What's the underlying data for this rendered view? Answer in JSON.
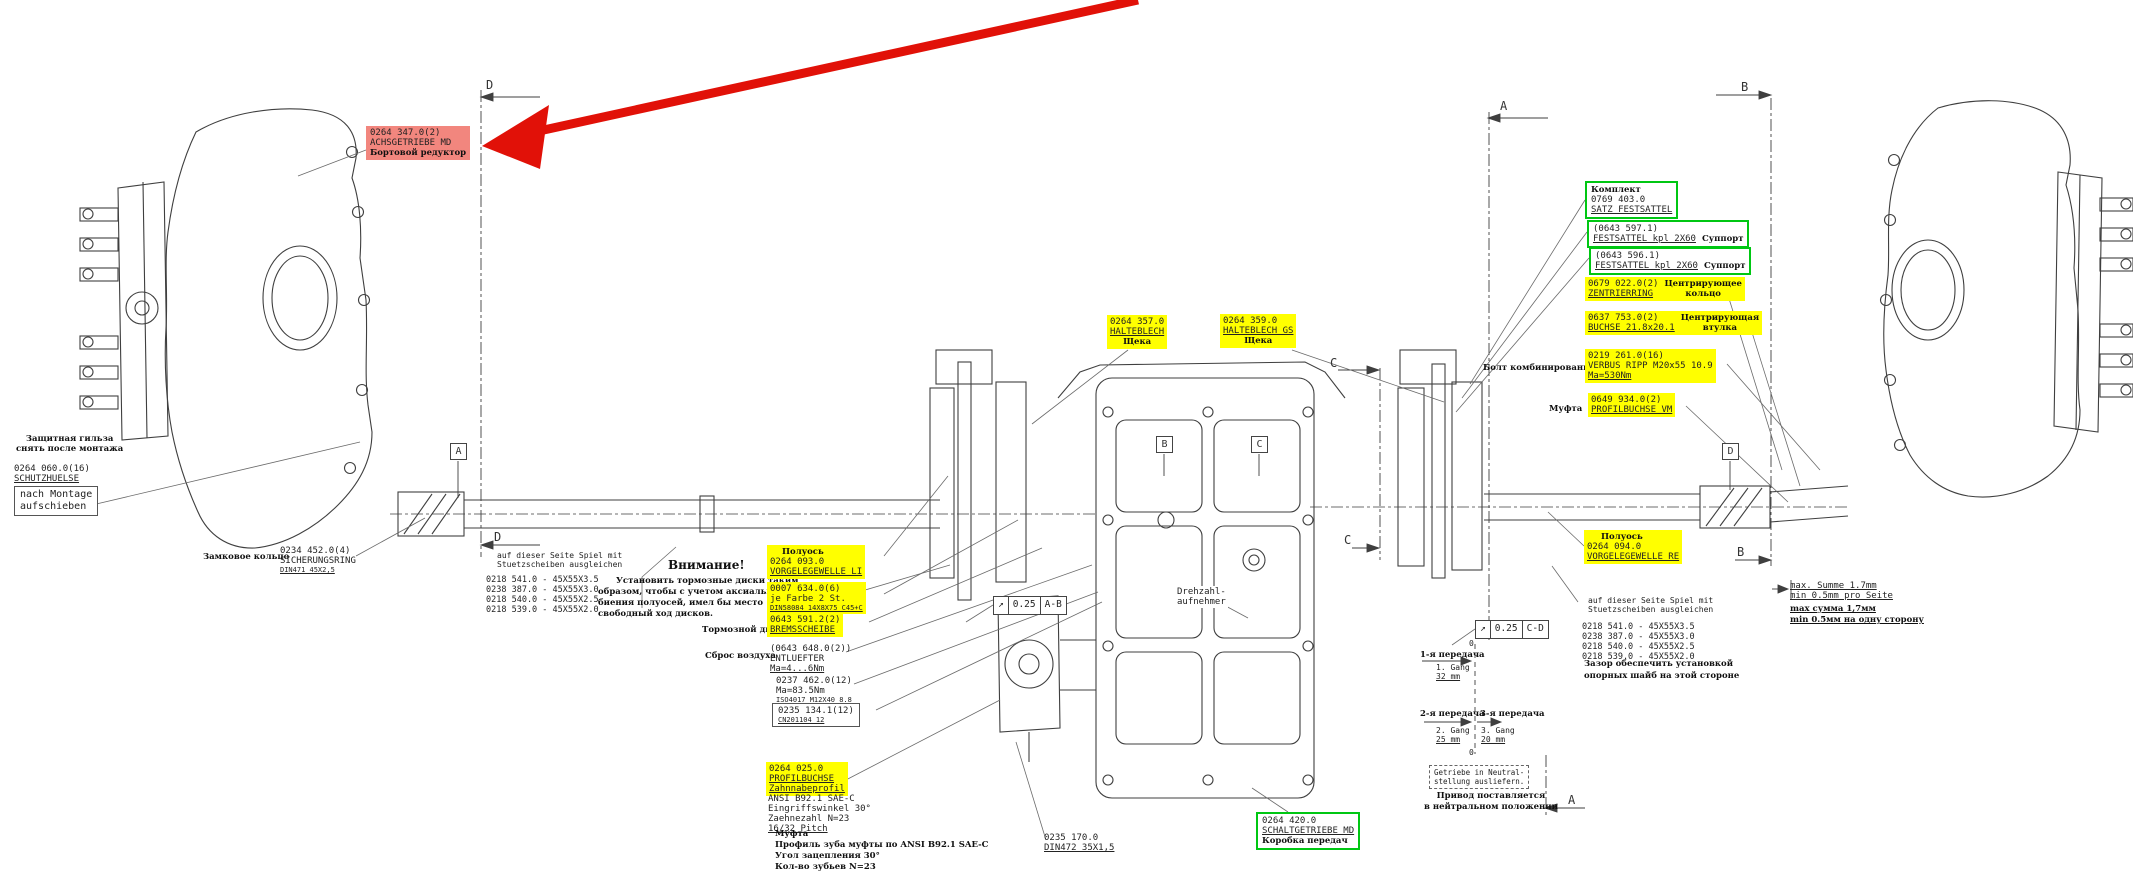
{
  "colors": {
    "highlight": "#ffff00",
    "green": "#00c713",
    "red_bg": "#f2867e",
    "arrow_red": "#e11108",
    "line": "#3f3f3f"
  },
  "red_callout": {
    "part": "0264 347.0(2)",
    "name": "ACHSGETRIEBE MD",
    "ru": "Бортовой редуктор"
  },
  "sleeve": {
    "ru1": "Защитная гильза",
    "ru2": "снять после монтажа",
    "part": "0264 060.0(16)",
    "name": "SCHUTZHUELSE",
    "note1": "nach Montage",
    "note2": "aufschieben"
  },
  "ring": {
    "ru": "Замковое кольцо",
    "part": "0234 452.0(4)",
    "name": "SICHERUNGSRING",
    "std": "DIN471 45X2,5"
  },
  "shims": {
    "note1": "auf dieser Seite Spiel mit",
    "note2": "Stuetzscheiben ausgleichen",
    "rows": [
      "0218 541.0 - 45X55X3.5",
      "0238 387.0 - 45X55X3.0",
      "0218 540.0 - 45X55X2.5",
      "0218 539.0 - 45X55X2.0"
    ],
    "ru1": "Зазор обеспечить установкой",
    "ru2": "опорных шайб на этой стороне"
  },
  "attention": {
    "title": "Внимание!",
    "l1": "Установить тормозные диски таким",
    "l2": "образом, чтобы с учетом аксиального",
    "l3": "биения полуосей, имел бы место",
    "l4": "свободный ход дисков."
  },
  "axle_left": {
    "ru": "Полуось",
    "part": "0264 093.0",
    "name": "VORGELEGEWELLE LI"
  },
  "axle_right": {
    "ru": "Полуось",
    "part": "0264 094.0",
    "name": "VORGELEGEWELLE RE"
  },
  "farbe": {
    "part": "0007 634.0(6)",
    "l2": "je Farbe 2 St.",
    "std": "DIN58084 14X8X75 C45+C"
  },
  "brake": {
    "ru": "Тормозной диск",
    "part": "0643 591.2(2)",
    "name": "BREMSSCHEIBE"
  },
  "vent": {
    "ru": "Сброс воздуха",
    "part": "(0643 648.0(2))",
    "name": "ENTLUEFTER",
    "torque": "Ma=4...6Nm"
  },
  "bolt12": {
    "part": "0237 462.0(12)",
    "torque": "Ma=83.5Nm",
    "std": "ISO4017 M12X40 8.8"
  },
  "washer12": {
    "part": "0235 134.1(12)",
    "std": "CN201104 12"
  },
  "profil": {
    "part": "0264 025.0",
    "name": "PROFILBUCHSE",
    "l3": "Zahnnabeprofil",
    "l4": "ANSI B92.1 SAE-C",
    "l5": "Eingriffswinkel 30°",
    "l6": "Zaehnezahl N=23",
    "l7": "16/32 Pitch",
    "ru1": "Муфта",
    "ru2": "Профиль зуба муфты по ANSI B92.1 SAE-C",
    "ru3": "Угол зацепления 30°",
    "ru4": "Кол-во зубьев N=23"
  },
  "circlip": {
    "part": "0235 170.0",
    "std": "DIN472 35X1,5"
  },
  "gearbox": {
    "part": "0264 420.0",
    "name": "SCHALTGETRIEBE MD",
    "ru": "Коробка передач"
  },
  "halteblech1": {
    "part": "0264 357.0",
    "name": "HALTEBLECH",
    "ru": "Щека"
  },
  "halteblech2": {
    "part": "0264 359.0",
    "name": "HALTEBLECH GS",
    "ru": "Щека"
  },
  "caliper_set": {
    "ru": "Комплект",
    "part": "0769 403.0",
    "name": "SATZ FESTSATTEL"
  },
  "caliper1": {
    "part": "(0643 597.1)",
    "name": "FESTSATTEL kpl 2X60",
    "ru": "Суппорт"
  },
  "caliper2": {
    "part": "(0643 596.1)",
    "name": "FESTSATTEL kpl 2X60",
    "ru": "Суппорт"
  },
  "zentrier": {
    "part": "0679 022.0(2)",
    "name": "ZENTRIERRING",
    "ru1": "Центрирующее",
    "ru2": "кольцо"
  },
  "buchse": {
    "part": "0637 753.0(2)",
    "name": "BUCHSE 21.8x20.1",
    "ru1": "Центрирующая",
    "ru2": "втулка"
  },
  "verbus": {
    "part": "0219 261.0(16)",
    "name": "VERBUS RIPP M20x55 10.9",
    "torque": "Ma=530Nm",
    "ru": "Болт комбинированный"
  },
  "muffe": {
    "part": "0649 934.0(2)",
    "name": "PROFILBUCHSE VM",
    "ru": "Муфта"
  },
  "summe": {
    "de1": "max. Summe 1.7mm",
    "de2": "min 0.5mm pro Seite",
    "ru1": "max сумма 1,7мм",
    "ru2": "min 0.5мм на одну сторону"
  },
  "sensor": {
    "l1": "Drehzahl-",
    "l2": "aufnehmer"
  },
  "gears": {
    "g1_ru": "1-я передача",
    "g1": "1. Gang",
    "g1_mm": "32 mm",
    "g2_ru": "2-я передача",
    "g2": "2. Gang",
    "g2_mm": "25 mm",
    "g3_ru": "3-я передача",
    "g3": "3. Gang",
    "g3_mm": "20 mm",
    "zero": "0",
    "neutral1": "Getriebe in Neutral-",
    "neutral2": "stellung ausliefern.",
    "neutral_ru1": "Привод поставляется",
    "neutral_ru2": "в нейтральном положении"
  },
  "tol": {
    "sym": "↗",
    "val": "0.25",
    "ab": "A-B",
    "cd": "C-D"
  },
  "sections": {
    "a": "A",
    "b": "B",
    "c": "C",
    "d": "D"
  }
}
